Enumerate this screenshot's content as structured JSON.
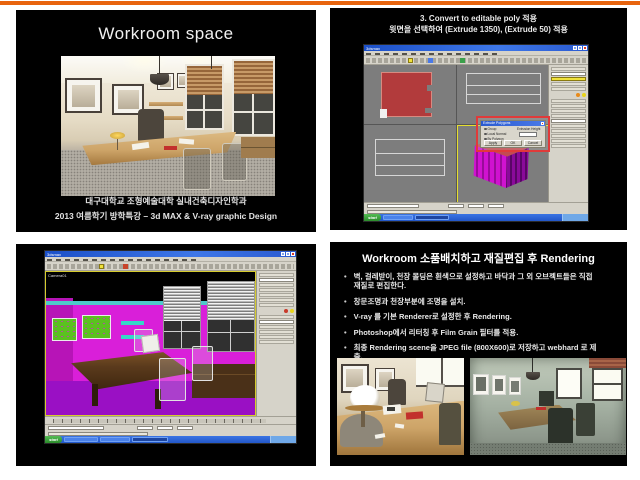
{
  "colors": {
    "accent_bar": "#e8640e",
    "slide_background": "#000000",
    "wall_magenta": "#d91fd9",
    "floor_purple": "#9a10c4",
    "xp_titlebar_blue": "#2a5ad0",
    "taskbar_blue": "#2a67d9",
    "start_green": "#3c9a3c",
    "highlight_red": "#e03a3a",
    "active_viewport_yellow": "#e6df2e",
    "shape_red": "#b23b3c"
  },
  "slide1": {
    "title": "Workroom space",
    "footer_line1": "대구대학교 조형예술대학 실내건축디자인학과",
    "footer_line2": "2013 여름학기 방학특강 – 3d MAX & V-ray graphic Design"
  },
  "slide2": {
    "heading_line1": "3. Convert to editable poly 적용",
    "heading_line2": "윗면을 선택하여 (Extrude 1350), (Extrude 50) 적용",
    "window_title": "3dsmax",
    "dialog": {
      "title": "Extrude Polygons",
      "option1": "Group",
      "option2": "Local Normal",
      "option3": "By Polygon",
      "height_label": "Extrusion Height",
      "apply_label": "Apply",
      "ok_label": "OK",
      "cancel_label": "Cancel"
    },
    "taskbar_start": "start"
  },
  "slide3": {
    "window_title": "3dsmax",
    "viewport_label": "Camera01",
    "taskbar_start": "start"
  },
  "slide4": {
    "title": "Workroom  소품배치하고 재질편집 후 Rendering",
    "bullet_char": "•",
    "bullets": [
      "벽, 걸레받이, 천장 몰딩은 흰색으로 설정하고 바닥과 그 외 오브젝트들은 직접 재질로 편집한다.",
      "창문조명과 천장부분에 조명을 설치.",
      "V-ray 를 기본 Renderer로 설정한 후 Rendering.",
      "Photoshop에서 리터칭 후  Film Grain 필터를 적용.",
      "최종 Rendering  scene을  JPEG file (800X600)로 저장하고  webhard 로 제출."
    ]
  }
}
